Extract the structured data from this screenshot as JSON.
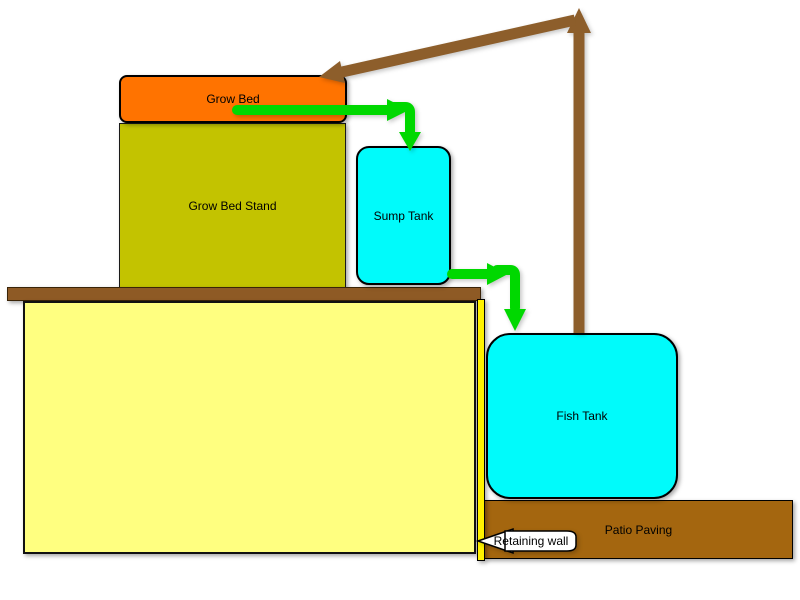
{
  "diagram": {
    "background": "#FFFFFF",
    "nodes": {
      "grow_bed": {
        "label": "Grow Bed",
        "fill": "#FF7300"
      },
      "grow_bed_stand": {
        "label": "Grow Bed Stand",
        "fill": "#C3C300"
      },
      "sump_tank": {
        "label": "Sump Tank",
        "fill": "#00FBFB"
      },
      "fish_tank": {
        "label": "Fish Tank",
        "fill": "#00FBFB"
      },
      "patio_paving": {
        "label": "Patio Paving",
        "fill": "#A4660F"
      },
      "retaining_wall": {
        "label": "Retaining wall",
        "fill": "#FFFFFF"
      },
      "wall_cap": {
        "fill": "#8E5A25"
      },
      "soil_wall": {
        "fill": "#FFFF80"
      },
      "wall_strip": {
        "fill": "#FFF200"
      }
    },
    "flows": {
      "pump_pipe_color": "#8D5E2B",
      "drain_flow_color": "#00D800"
    }
  }
}
